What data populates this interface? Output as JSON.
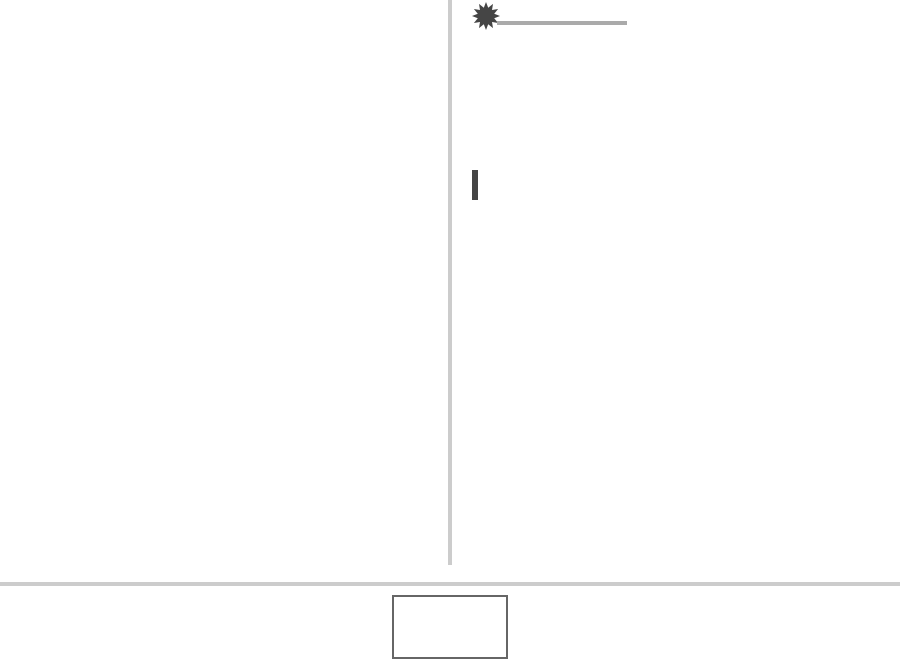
{
  "page": {
    "description": "Mostly blank two-column page with a starburst marker and placeholder rules",
    "visible_text": ""
  },
  "colors": {
    "background": "#ffffff",
    "divider": "#cccccc",
    "rule": "#aaaaaa",
    "accent_dark": "#454545",
    "box_border": "#666666"
  },
  "icons": {
    "starburst": "starburst-icon"
  }
}
